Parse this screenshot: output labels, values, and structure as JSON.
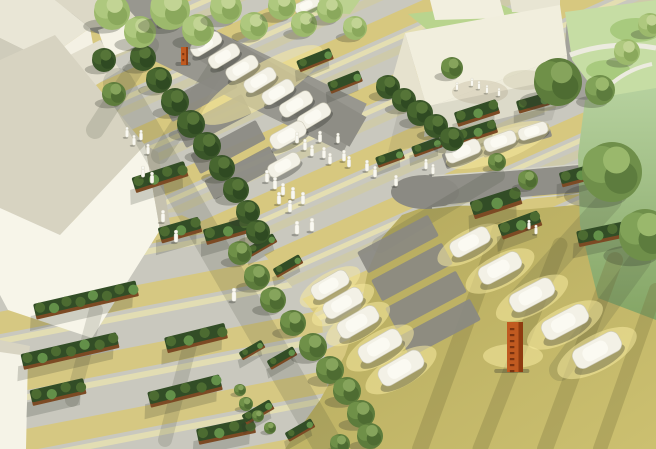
{
  "meta": {
    "description": "Aerial 3D architectural rendering of a landscaped parking plaza: striped yellow-and-grey paving, diagonal rows of trees and hedge planters, white low-poly parked cars, white pedestrian figures, white buildings around the edges, green lawns at top right and two orange corten-steel wayfinding totems."
  },
  "palette": {
    "pavement": "#c9c8be",
    "stripe-yellow": "#d9c878",
    "stripe-pale": "#e9e2b0",
    "stripe-soft": "#d6cd93",
    "olive-a": "#b3a85c",
    "olive-b": "#ccc070",
    "road": "#98978f",
    "road-dark": "#8e8d85",
    "lawn": "#c6dda4",
    "lawn-dark": "#a8ca7e",
    "green-wall-a": "#b6d19e",
    "green-wall-b": "#84a565",
    "building-white": "#f7f5e9",
    "building-shade": "#d7d3c1",
    "car-body": "#f3f1e6",
    "car-top": "#fbfaf2",
    "totem-orange": "#c05a20",
    "hedge-green": "#324d26",
    "hedge-edge": "#7c4a24"
  },
  "inventory": {
    "cars": 24,
    "trees": 49,
    "people": 39,
    "hedge_planters": 9,
    "hedge_islands": 17,
    "parking_stalls": 11,
    "totems": 2,
    "buildings": 7
  },
  "scene": {
    "cars": [
      [
        168,
        16,
        -28,
        26
      ],
      [
        206,
        44,
        -31,
        33
      ],
      [
        224,
        56,
        -31,
        33
      ],
      [
        242,
        68,
        -31,
        34
      ],
      [
        260,
        80,
        -31,
        34
      ],
      [
        278,
        92,
        -31,
        34
      ],
      [
        296,
        104,
        -31,
        35
      ],
      [
        314,
        116,
        -31,
        35
      ],
      [
        288,
        135,
        -29,
        38
      ],
      [
        284,
        165,
        -29,
        34
      ],
      [
        307,
        5,
        -25,
        26
      ],
      [
        463,
        151,
        -22,
        36
      ],
      [
        500,
        141,
        -20,
        33
      ],
      [
        533,
        131,
        -18,
        30
      ],
      [
        330,
        285,
        -30,
        40
      ],
      [
        343,
        303,
        -30,
        42
      ],
      [
        358,
        322,
        -30,
        44
      ],
      [
        380,
        346,
        -30,
        46
      ],
      [
        401,
        368,
        -30,
        48
      ],
      [
        470,
        242,
        -28,
        42
      ],
      [
        500,
        268,
        -28,
        45
      ],
      [
        532,
        295,
        -28,
        47
      ],
      [
        565,
        322,
        -28,
        49
      ],
      [
        597,
        350,
        -28,
        51
      ]
    ],
    "glows": [
      [
        262,
        85,
        70,
        20,
        -31
      ],
      [
        498,
        145,
        55,
        16,
        -20
      ],
      [
        330,
        287,
        34,
        14,
        -30
      ],
      [
        343,
        305,
        35,
        14,
        -30
      ],
      [
        358,
        324,
        36,
        15,
        -30
      ],
      [
        380,
        348,
        38,
        16,
        -30
      ],
      [
        401,
        370,
        40,
        16,
        -30
      ],
      [
        470,
        245,
        36,
        15,
        -28
      ],
      [
        500,
        271,
        38,
        16,
        -28
      ],
      [
        532,
        298,
        40,
        16,
        -28
      ],
      [
        565,
        325,
        42,
        17,
        -28
      ],
      [
        597,
        353,
        44,
        18,
        -28
      ],
      [
        513,
        356,
        30,
        12,
        0
      ]
    ],
    "stalls": [
      [
        200,
        95,
        74,
        22,
        -28
      ],
      [
        214,
        121,
        74,
        22,
        -28
      ],
      [
        228,
        147,
        74,
        22,
        -28
      ],
      [
        242,
        173,
        74,
        22,
        -28
      ],
      [
        398,
        244,
        80,
        24,
        -28
      ],
      [
        412,
        272,
        80,
        24,
        -28
      ],
      [
        426,
        300,
        80,
        24,
        -28
      ],
      [
        440,
        328,
        80,
        24,
        -28
      ],
      [
        463,
        155,
        40,
        16,
        -20
      ],
      [
        500,
        145,
        38,
        15,
        -18
      ],
      [
        533,
        135,
        36,
        14,
        -17
      ]
    ],
    "planters": [
      [
        86,
        300,
        105,
        -13
      ],
      [
        70,
        351,
        98,
        -13
      ],
      [
        58,
        392,
        55,
        -13
      ],
      [
        185,
        391,
        74,
        -14
      ],
      [
        196,
        338,
        62,
        -14
      ],
      [
        226,
        431,
        58,
        -12
      ],
      [
        160,
        177,
        55,
        -18
      ],
      [
        180,
        230,
        42,
        -16
      ],
      [
        227,
        231,
        46,
        -16
      ]
    ],
    "hedges": [
      [
        477,
        113,
        44,
        15,
        -18
      ],
      [
        533,
        103,
        32,
        13,
        -16
      ],
      [
        477,
        132,
        40,
        14,
        -18
      ],
      [
        496,
        203,
        50,
        18,
        -18
      ],
      [
        520,
        225,
        42,
        16,
        -20
      ],
      [
        580,
        175,
        40,
        15,
        -15
      ],
      [
        390,
        158,
        28,
        11,
        -20
      ],
      [
        315,
        60,
        36,
        12,
        -22
      ],
      [
        345,
        82,
        34,
        12,
        -22
      ],
      [
        612,
        232,
        70,
        16,
        -12
      ],
      [
        262,
        245,
        30,
        10,
        -30
      ],
      [
        288,
        266,
        30,
        10,
        -30
      ],
      [
        252,
        350,
        26,
        9,
        -30
      ],
      [
        282,
        358,
        30,
        10,
        -30
      ],
      [
        258,
        412,
        32,
        11,
        -30
      ],
      [
        300,
        430,
        30,
        10,
        -30
      ],
      [
        427,
        147,
        30,
        11,
        -20
      ]
    ],
    "trees": [
      [
        143,
        58,
        13,
        0
      ],
      [
        159,
        80,
        13,
        0
      ],
      [
        175,
        102,
        14,
        0
      ],
      [
        191,
        124,
        14,
        0
      ],
      [
        207,
        146,
        14,
        0
      ],
      [
        222,
        168,
        13,
        0
      ],
      [
        236,
        190,
        13,
        0
      ],
      [
        248,
        212,
        12,
        0
      ],
      [
        258,
        232,
        12,
        0
      ],
      [
        240,
        253,
        12,
        1
      ],
      [
        257,
        277,
        13,
        1
      ],
      [
        273,
        300,
        13,
        1
      ],
      [
        293,
        323,
        13,
        1
      ],
      [
        313,
        347,
        14,
        1
      ],
      [
        330,
        370,
        14,
        1
      ],
      [
        347,
        391,
        14,
        1
      ],
      [
        361,
        414,
        14,
        1
      ],
      [
        370,
        436,
        13,
        1
      ],
      [
        340,
        444,
        10,
        1
      ],
      [
        388,
        87,
        12,
        0
      ],
      [
        404,
        100,
        12,
        0
      ],
      [
        420,
        113,
        13,
        0
      ],
      [
        436,
        126,
        12,
        0
      ],
      [
        452,
        139,
        12,
        0
      ],
      [
        497,
        162,
        9,
        1
      ],
      [
        528,
        180,
        10,
        1
      ],
      [
        112,
        12,
        18,
        2
      ],
      [
        140,
        32,
        16,
        2
      ],
      [
        170,
        10,
        20,
        2
      ],
      [
        198,
        30,
        16,
        2
      ],
      [
        226,
        8,
        16,
        2
      ],
      [
        254,
        26,
        14,
        2
      ],
      [
        282,
        6,
        14,
        2
      ],
      [
        304,
        24,
        13,
        2
      ],
      [
        330,
        10,
        13,
        2
      ],
      [
        355,
        28,
        12,
        2
      ],
      [
        104,
        60,
        12,
        0
      ],
      [
        114,
        94,
        12,
        1
      ],
      [
        612,
        172,
        30,
        3
      ],
      [
        645,
        235,
        26,
        3
      ],
      [
        600,
        90,
        15,
        3
      ],
      [
        627,
        52,
        13,
        2
      ],
      [
        650,
        25,
        12,
        2
      ],
      [
        558,
        82,
        24,
        1
      ],
      [
        452,
        68,
        11,
        1
      ],
      [
        246,
        404,
        7,
        1
      ],
      [
        258,
        416,
        6,
        1
      ],
      [
        270,
        428,
        6,
        1
      ],
      [
        240,
        390,
        6,
        1
      ]
    ],
    "people": [
      [
        297,
        143,
        11
      ],
      [
        305,
        150,
        11
      ],
      [
        312,
        156,
        11
      ],
      [
        320,
        142,
        11
      ],
      [
        324,
        158,
        11
      ],
      [
        330,
        164,
        11
      ],
      [
        338,
        143,
        10
      ],
      [
        344,
        161,
        11
      ],
      [
        349,
        167,
        11
      ],
      [
        367,
        171,
        11
      ],
      [
        375,
        177,
        11
      ],
      [
        396,
        186,
        11
      ],
      [
        267,
        182,
        12
      ],
      [
        275,
        189,
        12
      ],
      [
        283,
        195,
        12
      ],
      [
        293,
        199,
        12
      ],
      [
        303,
        204,
        12
      ],
      [
        279,
        204,
        12
      ],
      [
        290,
        212,
        12
      ],
      [
        312,
        231,
        13
      ],
      [
        297,
        234,
        13
      ],
      [
        127,
        137,
        10
      ],
      [
        134,
        145,
        10
      ],
      [
        141,
        140,
        10
      ],
      [
        148,
        154,
        10
      ],
      [
        143,
        177,
        11
      ],
      [
        152,
        183,
        11
      ],
      [
        163,
        222,
        12
      ],
      [
        176,
        242,
        12
      ],
      [
        457,
        90,
        8
      ],
      [
        472,
        86,
        8
      ],
      [
        479,
        89,
        8
      ],
      [
        487,
        93,
        8
      ],
      [
        499,
        96,
        8
      ],
      [
        426,
        169,
        10
      ],
      [
        433,
        174,
        10
      ],
      [
        529,
        229,
        9
      ],
      [
        536,
        234,
        9
      ],
      [
        234,
        301,
        13
      ]
    ],
    "totems": [
      [
        507,
        322,
        16,
        50
      ],
      [
        181,
        47,
        7,
        18
      ]
    ]
  }
}
